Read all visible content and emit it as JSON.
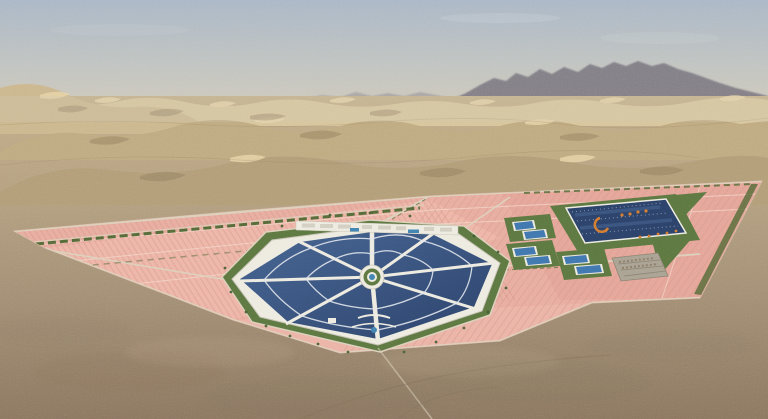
{
  "colors": {
    "sky_top": "#a9b6c5",
    "sky_mid": "#c0c3bf",
    "sky_horizon": "#d3c9b8",
    "mountain": "#6f6b77",
    "dune_light": "#d8c59b",
    "hill_left": "#cbb68c",
    "dune_ridge2": "#bea97f",
    "dune_ridge3": "#b19c76",
    "dune_highlight": "#e8d5a7",
    "dune_shadow": "#8d7a5c",
    "ground_far": "#c2ad86",
    "ground_mid": "#b29e7e",
    "ground_near": "#a18d73",
    "ground_fore": "#8a7560",
    "desert_dark": "#7c6954",
    "desert_light": "#cdb992",
    "field_pink": "#e8ab9e",
    "field_pink_light": "#f1bdae",
    "field_pink_dark": "#e2a093",
    "field_row": "#cf9184",
    "field_parcel_line": "#f3d8ca",
    "field_road": "#dccfba",
    "field_edge": "#d9b7a4",
    "hedge_green": "#4c6533",
    "lawn_green": "#5b7540",
    "tree_green": "#3f5a2e",
    "roof_navy": "#2b4168",
    "roof_navy_light": "#45628e",
    "roof_stripe": "#dfe4ec",
    "small_roof_blue": "#3f74ad",
    "building_white": "#edebe0",
    "building_shadow": "#c7c3b4",
    "pond_blue": "#4080b0",
    "logo_orange": "#d57a2e",
    "parking_gray": "#a8a090",
    "parking_line": "#87806f",
    "track_brown": "#7e6c58",
    "cloud_white": "#ffffff"
  }
}
